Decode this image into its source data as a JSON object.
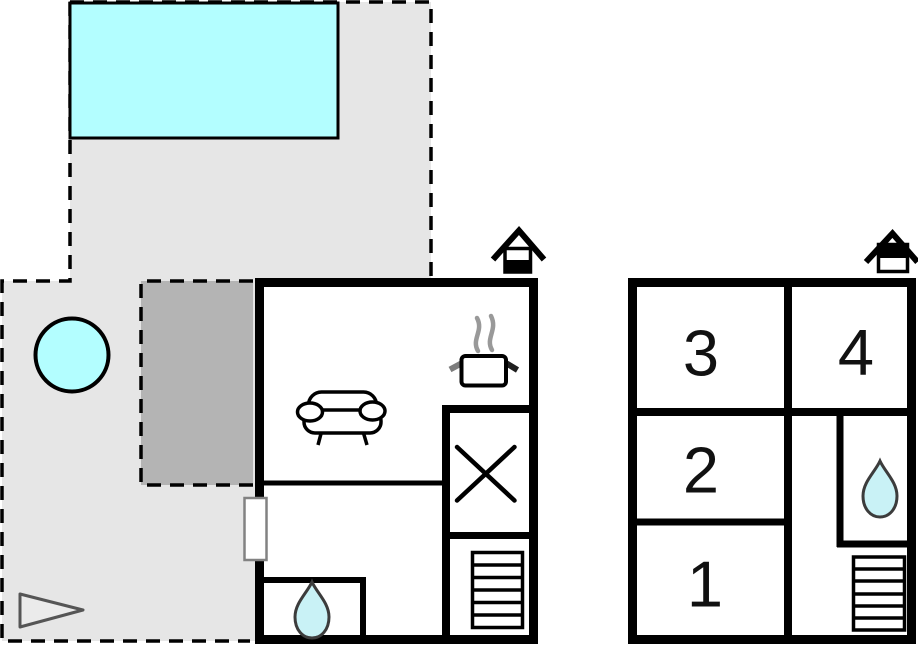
{
  "title": "Property floor plan",
  "colors": {
    "wall": "#000000",
    "water": "#b3feff",
    "drop": "#c9f2f6",
    "drop-outline": "#3c3c3c",
    "area-light": "#e6e6e6",
    "area-dark": "#b4b4b4",
    "door": "#828282",
    "steam": "#999999",
    "marker-fill": "#ebebeb",
    "marker-stroke": "#555555"
  },
  "icons": {
    "ground_floor_marker": "house-lower-half-filled",
    "upper_floor_marker": "house-upper-half-filled",
    "kitchen": "cooking-pot-with-steam",
    "hob": "x-cross",
    "stairs": "horizontal-treads",
    "bathroom": "water-drop",
    "living": "sofa",
    "pool": "water-rectangle",
    "hot_tub": "water-circle",
    "outdoor_marker": "triangle-pointer"
  },
  "upper_floor": {
    "rooms": [
      {
        "label": "1"
      },
      {
        "label": "2"
      },
      {
        "label": "3"
      },
      {
        "label": "4"
      }
    ]
  }
}
